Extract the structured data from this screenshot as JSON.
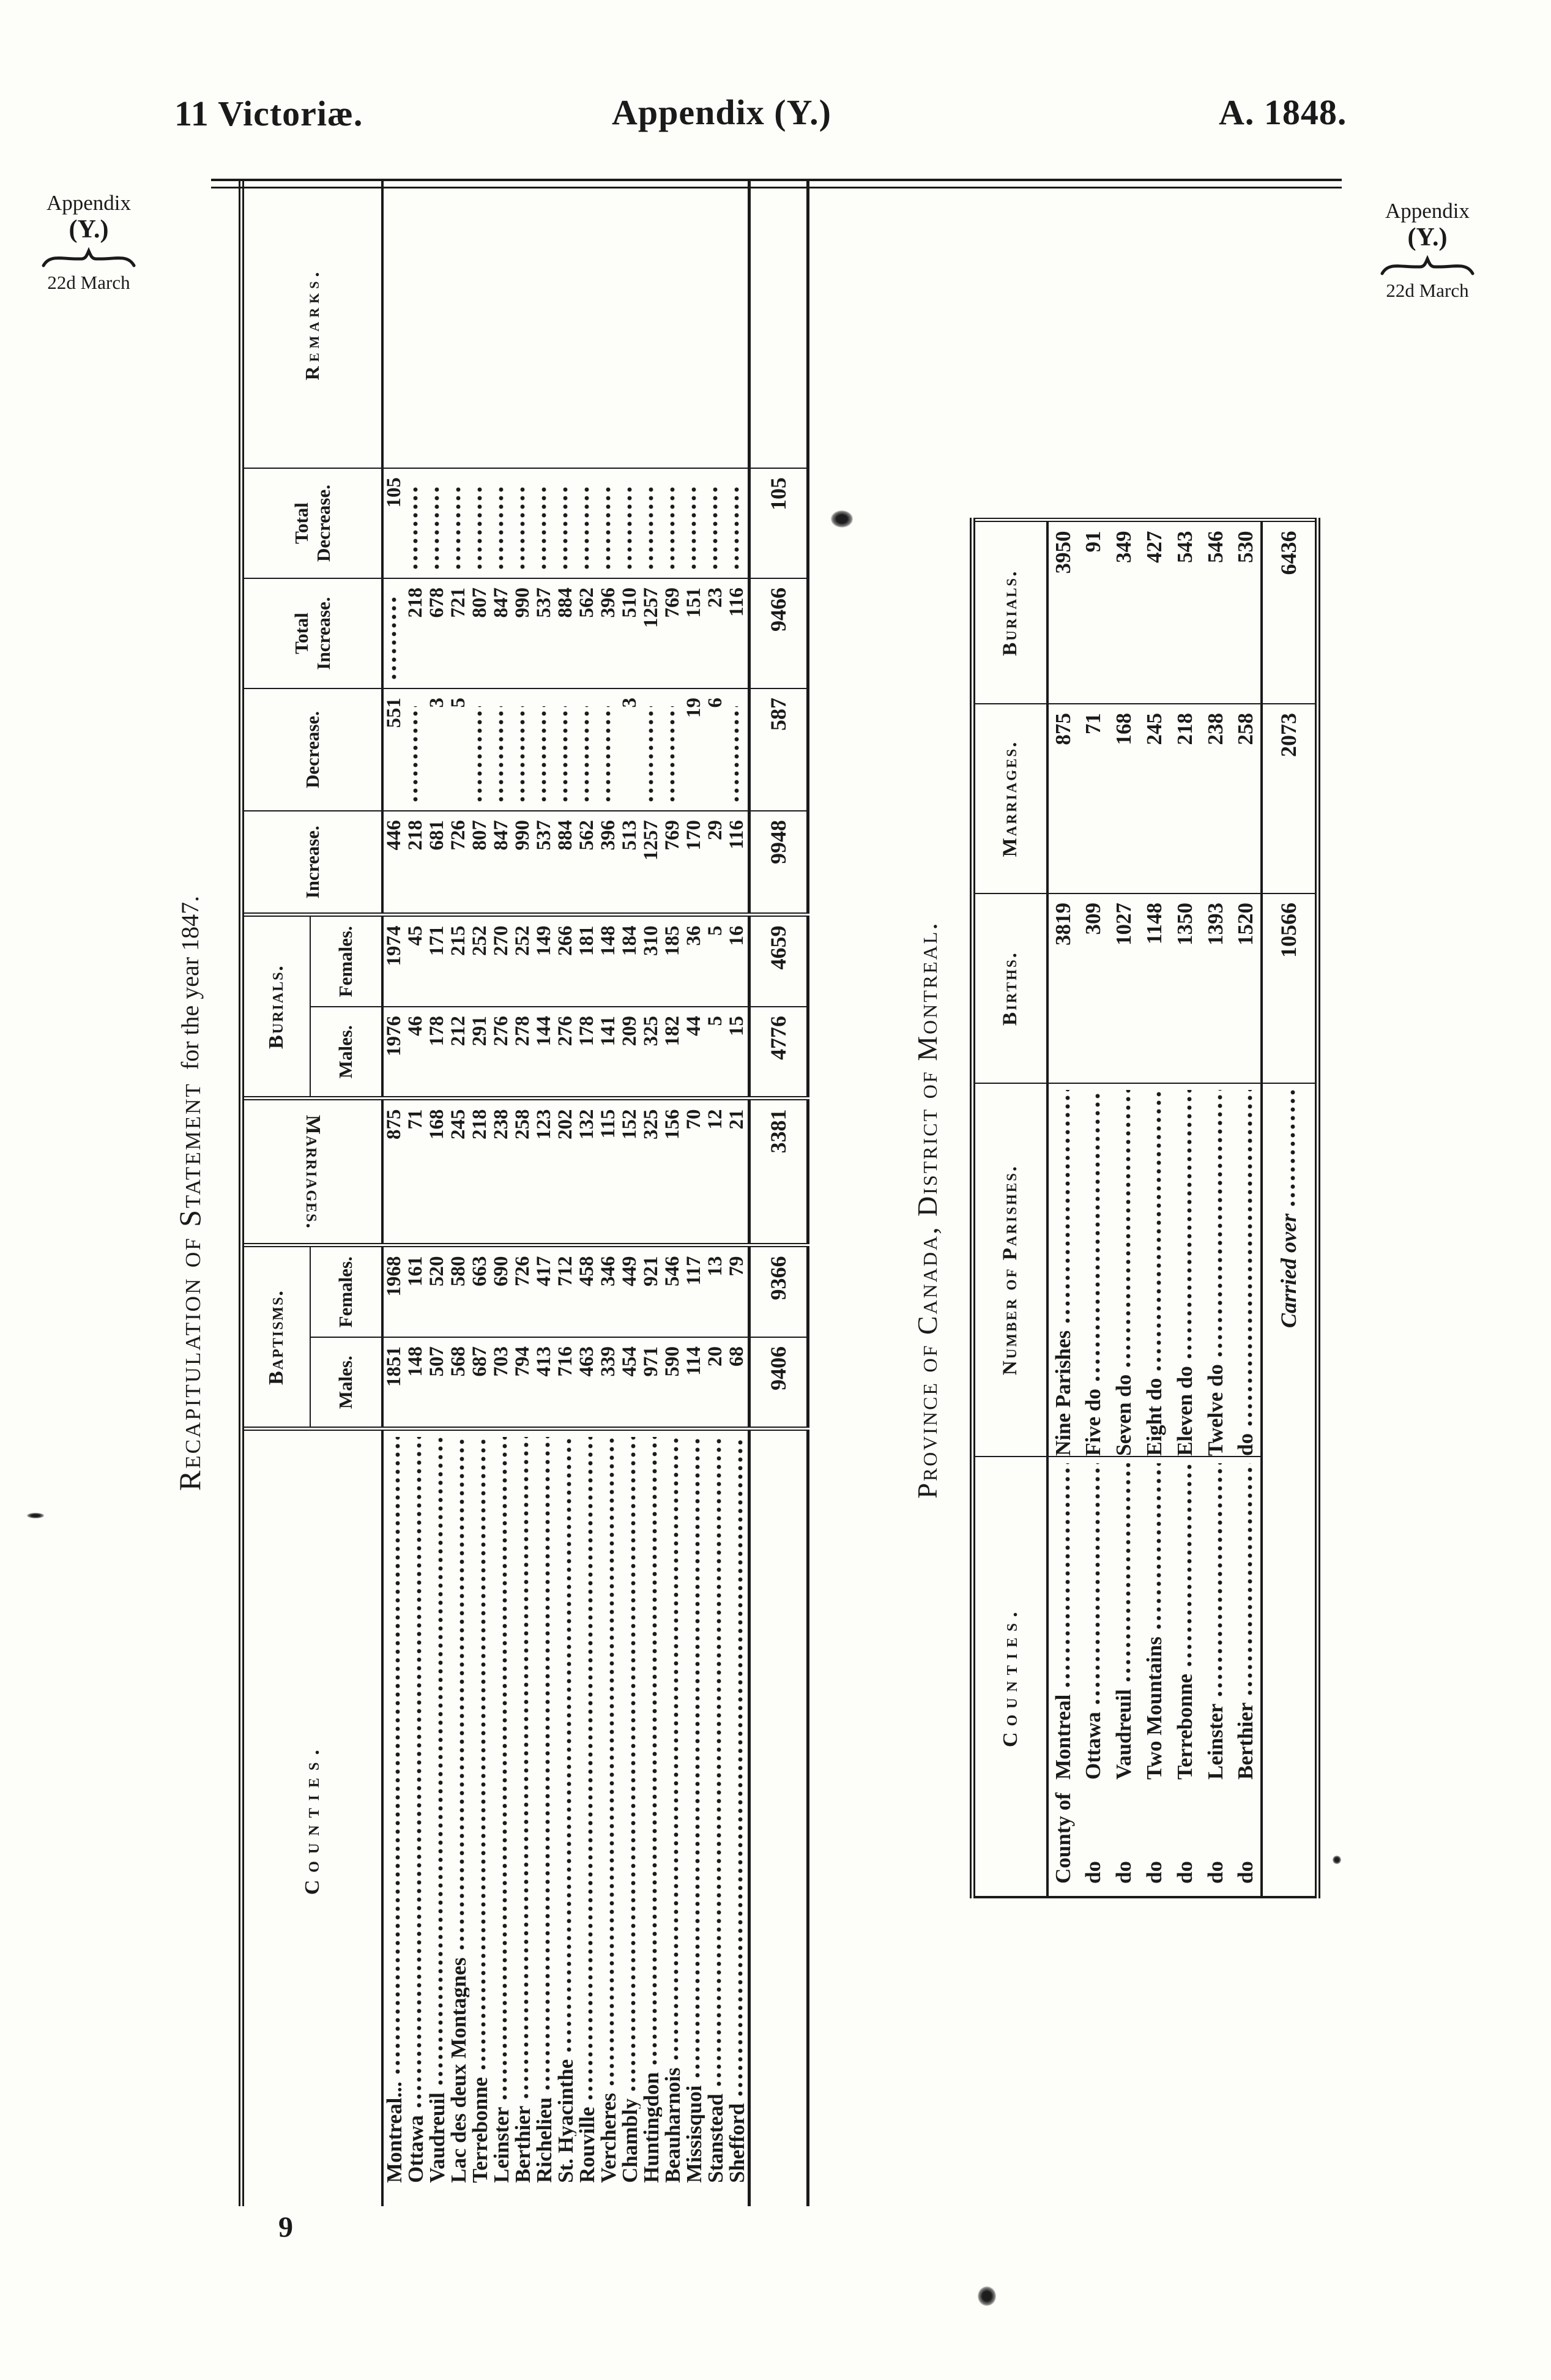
{
  "page_header": {
    "left": "11 Victoriæ.",
    "center": "Appendix (Y.)",
    "right": "A. 1848."
  },
  "margin_note_left": {
    "appendix": "Appendix",
    "y": "(Y.)",
    "date": "22d March"
  },
  "margin_note_right": {
    "appendix": "Appendix",
    "y": "(Y.)",
    "date": "22d March"
  },
  "page_number": "9",
  "recap_table": {
    "title_smallcaps": "Recapitulation of Statement",
    "title_rest": "for the year 1847.",
    "headers": {
      "counties": "Counties.",
      "baptisms": "Baptisms.",
      "marriages": "Marriages.",
      "burials": "Burials.",
      "males": "Males.",
      "females": "Females.",
      "increase": "Increase.",
      "decrease": "Decrease.",
      "total": "Total",
      "total_increase": "Increase.",
      "total_decrease": "Decrease.",
      "remarks": "Remarks."
    },
    "columns": [
      "County",
      "Baptisms Males",
      "Baptisms Females",
      "Marriages",
      "Burials Males",
      "Burials Females",
      "Increase",
      "Decrease",
      "Total Increase",
      "Total Decrease"
    ],
    "rows": [
      [
        "Montreal...",
        "1851",
        "1968",
        "875",
        "1976",
        "1974",
        "446",
        "551",
        "",
        "105"
      ],
      [
        "Ottawa",
        "148",
        "161",
        "71",
        "46",
        "45",
        "218",
        "",
        "218",
        ""
      ],
      [
        "Vaudreuil",
        "507",
        "520",
        "168",
        "178",
        "171",
        "681",
        "3",
        "678",
        ""
      ],
      [
        "Lac des deux Montagnes",
        "568",
        "580",
        "245",
        "212",
        "215",
        "726",
        "5",
        "721",
        ""
      ],
      [
        "Terrebonne",
        "687",
        "663",
        "218",
        "291",
        "252",
        "807",
        "",
        "807",
        ""
      ],
      [
        "Leinster",
        "703",
        "690",
        "238",
        "276",
        "270",
        "847",
        "",
        "847",
        ""
      ],
      [
        "Berthier",
        "794",
        "726",
        "258",
        "278",
        "252",
        "990",
        "",
        "990",
        ""
      ],
      [
        "Richelieu",
        "413",
        "417",
        "123",
        "144",
        "149",
        "537",
        "",
        "537",
        ""
      ],
      [
        "St. Hyacinthe",
        "716",
        "712",
        "202",
        "276",
        "266",
        "884",
        "",
        "884",
        ""
      ],
      [
        "Rouville",
        "463",
        "458",
        "132",
        "178",
        "181",
        "562",
        "",
        "562",
        ""
      ],
      [
        "Vercheres",
        "339",
        "346",
        "115",
        "141",
        "148",
        "396",
        "",
        "396",
        ""
      ],
      [
        "Chambly",
        "454",
        "449",
        "152",
        "209",
        "184",
        "513",
        "3",
        "510",
        ""
      ],
      [
        "Huntingdon",
        "971",
        "921",
        "325",
        "325",
        "310",
        "1257",
        "",
        "1257",
        ""
      ],
      [
        "Beauharnois",
        "590",
        "546",
        "156",
        "182",
        "185",
        "769",
        "",
        "769",
        ""
      ],
      [
        "Missisquoi",
        "114",
        "117",
        "70",
        "44",
        "36",
        "170",
        "19",
        "151",
        ""
      ],
      [
        "Stanstead",
        "20",
        "13",
        "12",
        "5",
        "5",
        "29",
        "6",
        "23",
        ""
      ],
      [
        "Shefford",
        "68",
        "79",
        "21",
        "15",
        "16",
        "116",
        "",
        "116",
        ""
      ]
    ],
    "totals": [
      "",
      "9406",
      "9366",
      "3381",
      "4776",
      "4659",
      "9948",
      "587",
      "9466",
      "105"
    ]
  },
  "parish_table": {
    "title": "Province of Canada, District of Montreal.",
    "headers": {
      "counties": "Counties.",
      "parishes": "Number of Parishes.",
      "births": "Births.",
      "marriages": "Marriages.",
      "burials": "Burials."
    },
    "rows": [
      [
        "County of",
        "Montreal",
        "Nine Parishes",
        "3819",
        "875",
        "3950"
      ],
      [
        "do",
        "Ottawa",
        "Five do",
        "309",
        "71",
        "91"
      ],
      [
        "do",
        "Vaudreuil",
        "Seven do",
        "1027",
        "168",
        "349"
      ],
      [
        "do",
        "Two Mountains",
        "Eight do",
        "1148",
        "245",
        "427"
      ],
      [
        "do",
        "Terrebonne",
        "Eleven do",
        "1350",
        "218",
        "543"
      ],
      [
        "do",
        "Leinster",
        "Twelve do",
        "1393",
        "238",
        "546"
      ],
      [
        "do",
        "Berthier",
        "do",
        "1520",
        "258",
        "530"
      ]
    ],
    "carried_over": {
      "label": "Carried over",
      "births": "10566",
      "marriages": "2073",
      "burials": "6436"
    }
  }
}
